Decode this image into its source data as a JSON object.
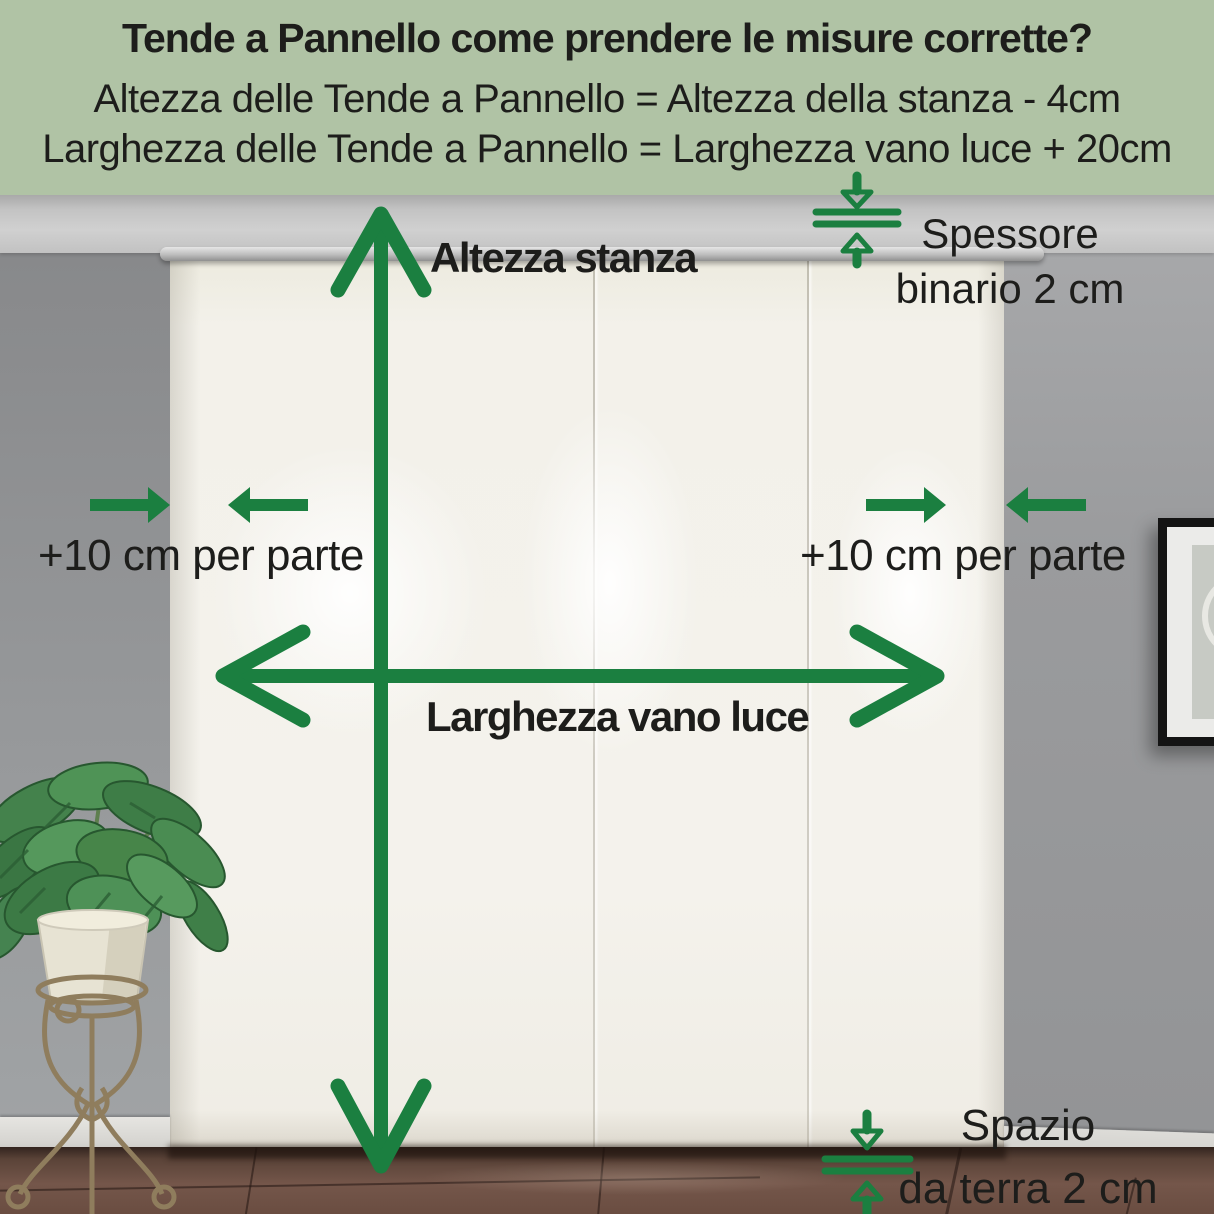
{
  "header": {
    "title": "Tende a Pannello come prendere le misure corrette?",
    "formula_height": "Altezza delle Tende a Pannello = Altezza della stanza - 4cm",
    "formula_width": "Larghezza delle Tende a Pannello = Larghezza vano luce + 20cm"
  },
  "annotations": {
    "room_height": "Altezza stanza",
    "track_thickness_line1": "Spessore",
    "track_thickness_line2": "binario 2 cm",
    "extra_width_left": "+10 cm per parte",
    "extra_width_right": "+10 cm per parte",
    "opening_width": "Larghezza vano luce",
    "floor_gap_line1": "Spazio",
    "floor_gap_line2": "da terra 2 cm"
  },
  "colors": {
    "accent_green": "#1b7f40",
    "header_bg": "#b0c3a5",
    "text": "#1d1d1b"
  }
}
